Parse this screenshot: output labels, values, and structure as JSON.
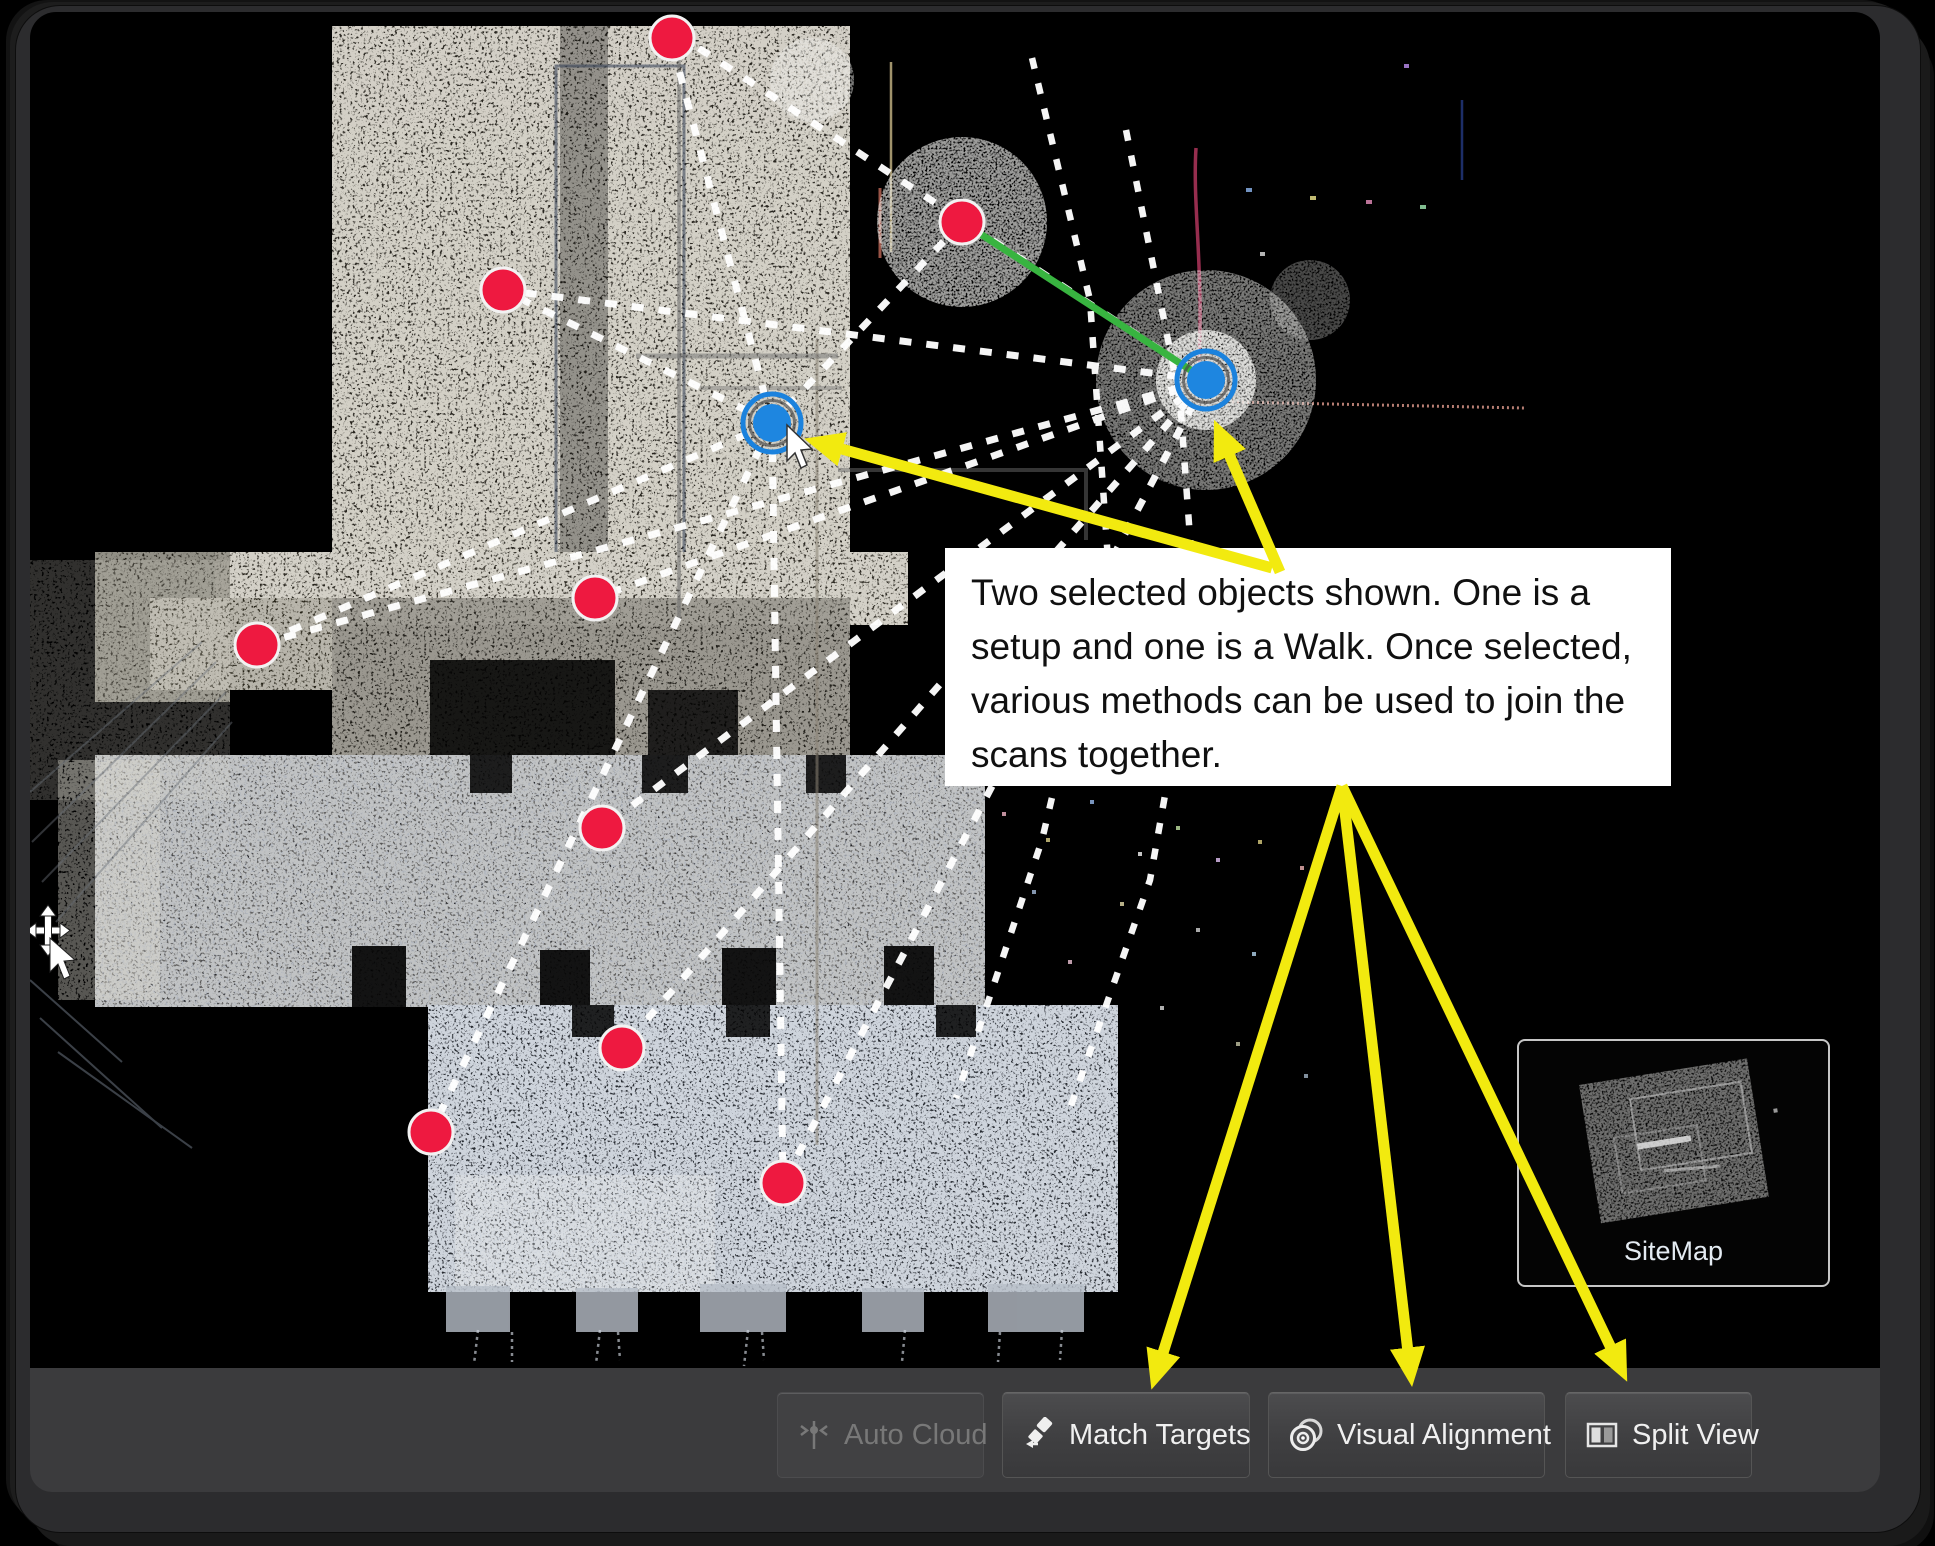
{
  "annotation": {
    "text": "Two selected objects shown. One is a setup and one is a Walk. Once selected, various methods can be used to join the scans together."
  },
  "sitemap": {
    "label": "SiteMap"
  },
  "toolbar": {
    "buttons": [
      {
        "label": "Auto Cloud",
        "icon": "auto-cloud-icon",
        "disabled": true
      },
      {
        "label": "Match Targets",
        "icon": "match-targets-icon",
        "disabled": false
      },
      {
        "label": "Visual Alignment",
        "icon": "visual-alignment-icon",
        "disabled": false
      },
      {
        "label": "Split View",
        "icon": "split-view-icon",
        "disabled": false
      }
    ]
  },
  "colors": {
    "arrow_yellow": "#f2ea0f",
    "marker_red": "#ee1940",
    "marker_blue": "#1e86e0",
    "link_green": "#38b440",
    "dashed_line": "#ffffff",
    "toolbar_bg": "#3b3b3d",
    "annotation_bg": "#ffffff"
  }
}
